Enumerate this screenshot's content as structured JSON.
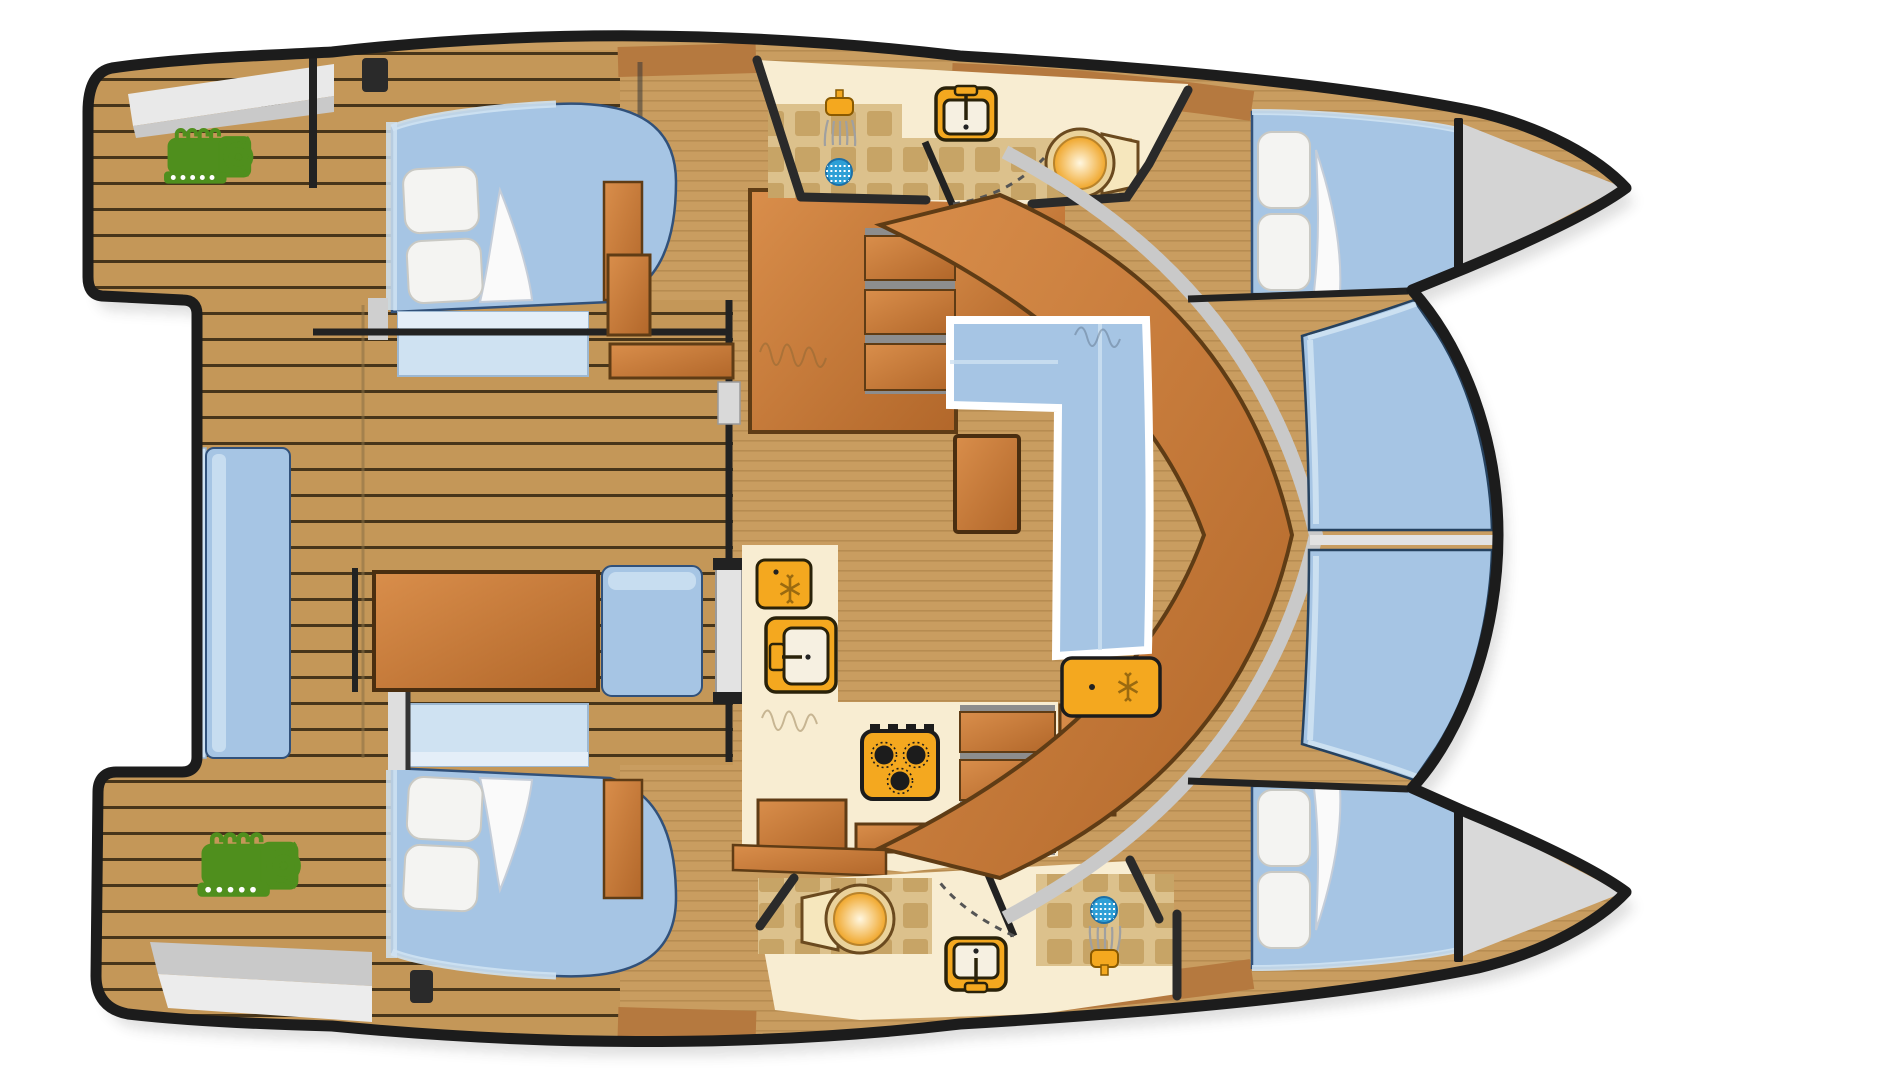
{
  "page": {
    "background": "#ffffff",
    "description": "Top-down catamaran yacht accommodation floor plan, bow pointing right"
  },
  "colors": {
    "outline": "#1c1c1c",
    "teak_deck": "#c49758",
    "plank_seam": "#47351a",
    "interior_floor": "#c99d60",
    "floor_stripe": "#b0854a",
    "wood_light": "#d98e4b",
    "wood_dark": "#b2672a",
    "wood_edge": "#5f3c15",
    "counter_cream": "#f8edd2",
    "tile_beige": "#dcc18c",
    "tile_square": "#c5a162",
    "cushion_blue": "#a6c5e4",
    "cushion_blue_light": "#cfe2f2",
    "cushion_edge": "#31517a",
    "pillow_white": "#f4f4f2",
    "platform_gray": "#d4d4d4",
    "platform_light": "#e9e9e9",
    "walkway_gray": "#c9c9c9",
    "engine_green": "#4f8f1d",
    "fixture_orange": "#f4a81f",
    "fixture_outline": "#2a2209",
    "toilet_ring": "#ead29b",
    "drain_blue": "#2e9fd6",
    "step_gray": "#8d8d8d",
    "door_gray": "#e3e3e3"
  },
  "areas": [
    {
      "name": "aft-swim-platforms"
    },
    {
      "name": "port-aft-deck"
    },
    {
      "name": "starboard-aft-deck"
    },
    {
      "name": "aft-cockpit"
    },
    {
      "name": "port-aft-cabin"
    },
    {
      "name": "starboard-aft-cabin"
    },
    {
      "name": "port-head"
    },
    {
      "name": "starboard-head"
    },
    {
      "name": "salon-dinette"
    },
    {
      "name": "galley"
    },
    {
      "name": "companionway-stairs"
    },
    {
      "name": "port-forward-cabin"
    },
    {
      "name": "starboard-forward-cabin"
    },
    {
      "name": "foredeck-lounge"
    },
    {
      "name": "bow-lockers"
    }
  ],
  "icons": [
    {
      "name": "engine-icon",
      "count": 2
    },
    {
      "name": "bed-icon",
      "count": 4
    },
    {
      "name": "pillow-icon",
      "count": 8
    },
    {
      "name": "shower-icon",
      "count": 2
    },
    {
      "name": "shower-drain-icon",
      "count": 2
    },
    {
      "name": "toilet-icon",
      "count": 2
    },
    {
      "name": "sink-icon",
      "count": 3
    },
    {
      "name": "fridge-icon",
      "count": 2
    },
    {
      "name": "stove-icon",
      "count": 1
    },
    {
      "name": "door-swing-icon",
      "count": 2
    },
    {
      "name": "stairs-icon",
      "count": 2
    }
  ]
}
